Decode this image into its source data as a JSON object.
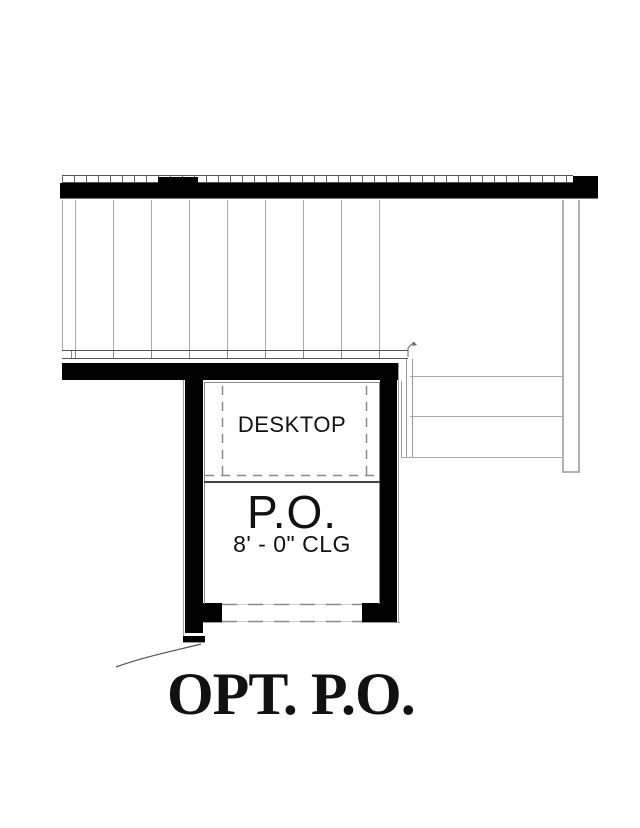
{
  "plan": {
    "desktop_label": "DESKTOP",
    "room_label": "P.O.",
    "ceiling_label": "8' - 0\" CLG",
    "caption": "OPT. P.O.",
    "colors": {
      "wall": "#000000",
      "thin_line": "#9a9a9a",
      "dashed_line": "#8a8a8a",
      "text": "#111111"
    }
  }
}
